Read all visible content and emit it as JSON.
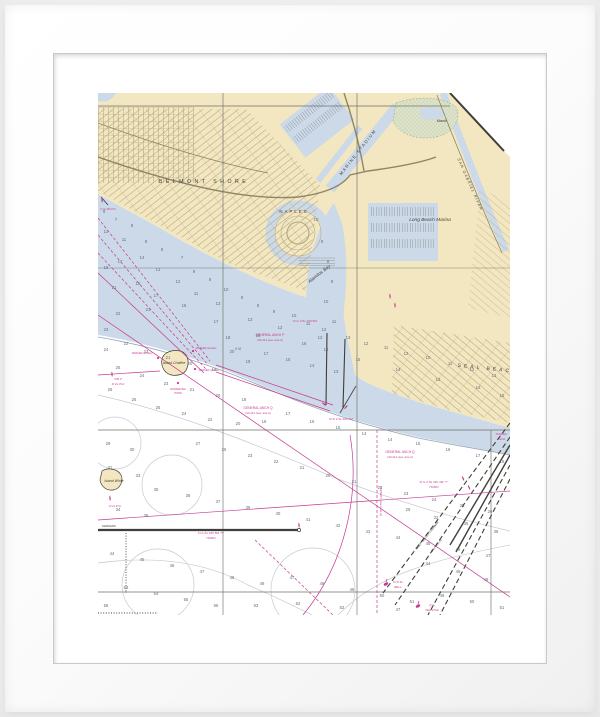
{
  "artwork": {
    "kind": "framed nautical chart art print",
    "subject": "Long Beach / Alamitos Bay / Seal Beach harbor chart"
  },
  "frame": {
    "frame_color": "#ffffff",
    "mat_color": "#ffffff"
  },
  "chart": {
    "colors": {
      "land": "#f2e7c1",
      "water": "#ccd9e8",
      "marsh": "#dde3c9",
      "magenta": "#c63a8f",
      "sounding": "#5f6e7c",
      "contour": "#c3cbd2",
      "street": "#b2a67c",
      "road": "#8f8566",
      "ink": "#3f3e38",
      "graticule": "#6f6f68"
    },
    "labels": [
      {
        "t": "BELMONT SHORE",
        "x": 106,
        "y": 90,
        "r": 0,
        "s": 5.2,
        "c": "ink",
        "sp": 3.5
      },
      {
        "t": "NAPLES",
        "x": 196,
        "y": 120,
        "r": 0,
        "s": 4.4,
        "c": "ink",
        "sp": 2
      },
      {
        "t": "MARINE STADIUM",
        "x": 261,
        "y": 60,
        "r": -52,
        "s": 4.2,
        "c": "ink",
        "sp": 1.5
      },
      {
        "t": "Alamitos Bay",
        "x": 222,
        "y": 182,
        "r": -38,
        "s": 4.6,
        "c": "ink",
        "i": 1
      },
      {
        "t": "Long Beach Marina",
        "x": 332,
        "y": 128,
        "r": 0,
        "s": 4.8,
        "c": "ink",
        "i": 1
      },
      {
        "t": "Marsh",
        "x": 344,
        "y": 29,
        "r": 0,
        "s": 3.8,
        "c": "ink",
        "i": 1
      },
      {
        "t": "SAN GABRIEL RIVER",
        "x": 371,
        "y": 92,
        "r": 66,
        "s": 3.7,
        "c": "ink",
        "sp": 1.2,
        "i": 1
      },
      {
        "t": "SEAL BEACH",
        "x": 390,
        "y": 277,
        "r": 6,
        "s": 5,
        "c": "ink",
        "sp": 3
      },
      {
        "t": "Island Chaffee",
        "x": 76,
        "y": 271,
        "r": 0,
        "s": 3.5,
        "c": "ink",
        "i": 1
      },
      {
        "t": "Island White",
        "x": 16,
        "y": 389,
        "r": 0,
        "s": 3.5,
        "c": "ink",
        "i": 1
      },
      {
        "t": "GENERAL ANCH P",
        "x": 172,
        "y": 243,
        "r": 0,
        "s": 3.3,
        "c": "magenta"
      },
      {
        "t": "110.214 (see note A)",
        "x": 172,
        "y": 248,
        "r": 0,
        "s": 2.8,
        "c": "magenta"
      },
      {
        "t": "GENERAL ANCH Q",
        "x": 160,
        "y": 316,
        "r": 0,
        "s": 3.3,
        "c": "magenta"
      },
      {
        "t": "110.214 (see note A)",
        "x": 160,
        "y": 321,
        "r": 0,
        "s": 2.8,
        "c": "magenta"
      },
      {
        "t": "GENERAL ANCH Q",
        "x": 302,
        "y": 360,
        "r": 0,
        "s": 3.3,
        "c": "magenta"
      },
      {
        "t": "110.214 (see note A)",
        "x": 302,
        "y": 365,
        "r": 0,
        "s": 2.8,
        "c": "magenta"
      },
      {
        "t": "Fl G 2.5s 16ft 5M",
        "x": 207,
        "y": 229,
        "r": 0,
        "s": 3.1,
        "c": "magenta"
      },
      {
        "t": "Fl R 2.5s 20ft 4M",
        "x": 243,
        "y": 327,
        "r": 0,
        "s": 3.1,
        "c": "magenta"
      },
      {
        "t": "Fl G 6s 42ft 5M \"T\"",
        "x": 113,
        "y": 441,
        "r": 0,
        "s": 3.1,
        "c": "magenta"
      },
      {
        "t": "HORN",
        "x": 113,
        "y": 446,
        "r": 0,
        "s": 3.1,
        "c": "magenta"
      },
      {
        "t": "Fl G 2.5s 31ft 4M \"Y\"",
        "x": 336,
        "y": 390,
        "r": 0,
        "s": 3.1,
        "c": "magenta"
      },
      {
        "t": "HORN",
        "x": 336,
        "y": 395,
        "r": 0,
        "s": 3.1,
        "c": "magenta"
      },
      {
        "t": "Fl R 4s",
        "x": 300,
        "y": 490,
        "r": 0,
        "s": 3,
        "c": "magenta"
      },
      {
        "t": "BELL",
        "x": 300,
        "y": 495,
        "r": 0,
        "s": 3,
        "c": "magenta"
      },
      {
        "t": "Q G",
        "x": 334,
        "y": 513,
        "r": 0,
        "s": 3,
        "c": "magenta"
      },
      {
        "t": "WHISTLE",
        "x": 334,
        "y": 518,
        "r": 0,
        "s": 3,
        "c": "magenta"
      },
      {
        "t": "\"OB 2\"",
        "x": 20,
        "y": 287,
        "r": 0,
        "s": 3,
        "c": "magenta",
        "i": 1
      },
      {
        "t": "Fl 2s Priv",
        "x": 20,
        "y": 292,
        "r": 0,
        "s": 3,
        "c": "magenta",
        "i": 1
      },
      {
        "t": "MARKER (private)",
        "x": 44,
        "y": 261,
        "r": 0,
        "s": 2.5,
        "c": "magenta"
      },
      {
        "t": "MARKER (private)",
        "x": 108,
        "y": 256,
        "r": 0,
        "s": 2.5,
        "c": "magenta"
      },
      {
        "t": "MARKER (private)",
        "x": 111,
        "y": 278,
        "r": 0,
        "s": 2.5,
        "c": "magenta"
      },
      {
        "t": "MARKER Bell",
        "x": 80,
        "y": 297,
        "r": 0,
        "s": 2.5,
        "c": "magenta"
      },
      {
        "t": "HORN",
        "x": 80,
        "y": 301,
        "r": 0,
        "s": 2.5,
        "c": "magenta"
      },
      {
        "t": "MARKERS",
        "x": 11,
        "y": 434,
        "r": 0,
        "s": 2.8,
        "c": "ink"
      },
      {
        "t": "Fl 2s Priv",
        "x": 17,
        "y": 414,
        "r": 0,
        "s": 2.9,
        "c": "magenta",
        "i": 1
      },
      {
        "t": "Fl 4s 30ft Priv",
        "x": 10,
        "y": 117,
        "r": 0,
        "s": 2.5,
        "c": "magenta"
      },
      {
        "t": "FAIRWAY (see note A)",
        "x": 282,
        "y": 408,
        "r": 90,
        "s": 3,
        "c": "magenta"
      },
      {
        "t": "DEEP WATER FAIRWAY",
        "x": 330,
        "y": 443,
        "r": -51,
        "s": 3.2,
        "c": "ink"
      },
      {
        "t": "(see note A)",
        "x": 339,
        "y": 453,
        "r": -51,
        "s": 2.9,
        "c": "ink"
      },
      {
        "t": "TANKER",
        "x": 403,
        "y": 342,
        "r": 0,
        "s": 2.9,
        "c": "magenta"
      },
      {
        "t": "ANCH",
        "x": 403,
        "y": 347,
        "r": 0,
        "s": 2.9,
        "c": "magenta"
      },
      {
        "t": "6 M",
        "x": 140,
        "y": 257,
        "r": 0,
        "s": 3.4,
        "c": "sounding",
        "i": 1
      }
    ],
    "soundings": [
      [
        6,
        120,
        "9"
      ],
      [
        18,
        128,
        "7"
      ],
      [
        34,
        134,
        "8"
      ],
      [
        8,
        140,
        "12"
      ],
      [
        26,
        148,
        "11"
      ],
      [
        48,
        150,
        "9"
      ],
      [
        64,
        158,
        "8"
      ],
      [
        84,
        166,
        "7"
      ],
      [
        44,
        166,
        "14"
      ],
      [
        22,
        170,
        "17"
      ],
      [
        8,
        176,
        "18"
      ],
      [
        60,
        178,
        "13"
      ],
      [
        96,
        180,
        "9"
      ],
      [
        112,
        188,
        "8"
      ],
      [
        80,
        190,
        "12"
      ],
      [
        40,
        192,
        "18"
      ],
      [
        16,
        196,
        "21"
      ],
      [
        58,
        204,
        "17"
      ],
      [
        98,
        202,
        "11"
      ],
      [
        128,
        198,
        "10"
      ],
      [
        144,
        206,
        "9"
      ],
      [
        120,
        212,
        "13"
      ],
      [
        86,
        214,
        "16"
      ],
      [
        50,
        218,
        "21"
      ],
      [
        20,
        222,
        "22"
      ],
      [
        160,
        214,
        "8"
      ],
      [
        176,
        220,
        "9"
      ],
      [
        196,
        224,
        "10"
      ],
      [
        152,
        228,
        "13"
      ],
      [
        118,
        230,
        "17"
      ],
      [
        182,
        236,
        "12"
      ],
      [
        210,
        232,
        "11"
      ],
      [
        226,
        238,
        "12"
      ],
      [
        160,
        244,
        "15"
      ],
      [
        130,
        246,
        "18"
      ],
      [
        250,
        246,
        "13"
      ],
      [
        268,
        252,
        "12"
      ],
      [
        288,
        256,
        "11"
      ],
      [
        308,
        262,
        "12"
      ],
      [
        330,
        266,
        "10"
      ],
      [
        352,
        272,
        "11"
      ],
      [
        374,
        278,
        "12"
      ],
      [
        396,
        284,
        "13"
      ],
      [
        260,
        268,
        "15"
      ],
      [
        300,
        278,
        "14"
      ],
      [
        340,
        288,
        "13"
      ],
      [
        380,
        296,
        "14"
      ],
      [
        404,
        304,
        "15"
      ],
      [
        228,
        258,
        "14"
      ],
      [
        206,
        252,
        "16"
      ],
      [
        8,
        238,
        "23"
      ],
      [
        8,
        258,
        "24"
      ],
      [
        28,
        252,
        "22"
      ],
      [
        48,
        260,
        "23"
      ],
      [
        70,
        266,
        "21"
      ],
      [
        92,
        272,
        "20"
      ],
      [
        116,
        278,
        "19"
      ],
      [
        20,
        276,
        "25"
      ],
      [
        44,
        284,
        "24"
      ],
      [
        68,
        292,
        "23"
      ],
      [
        94,
        298,
        "21"
      ],
      [
        120,
        304,
        "20"
      ],
      [
        146,
        308,
        "18"
      ],
      [
        12,
        298,
        "26"
      ],
      [
        36,
        308,
        "26"
      ],
      [
        60,
        316,
        "25"
      ],
      [
        86,
        322,
        "24"
      ],
      [
        112,
        328,
        "22"
      ],
      [
        140,
        332,
        "20"
      ],
      [
        166,
        330,
        "18"
      ],
      [
        190,
        322,
        "17"
      ],
      [
        214,
        330,
        "16"
      ],
      [
        240,
        336,
        "15"
      ],
      [
        266,
        342,
        "14"
      ],
      [
        292,
        348,
        "14"
      ],
      [
        320,
        352,
        "15"
      ],
      [
        350,
        358,
        "16"
      ],
      [
        380,
        364,
        "17"
      ],
      [
        404,
        370,
        "18"
      ],
      [
        168,
        262,
        "17"
      ],
      [
        190,
        268,
        "15"
      ],
      [
        214,
        274,
        "14"
      ],
      [
        238,
        280,
        "13"
      ],
      [
        150,
        270,
        "19"
      ],
      [
        134,
        260,
        "20"
      ],
      [
        10,
        352,
        "29"
      ],
      [
        34,
        358,
        "30"
      ],
      [
        12,
        376,
        "31"
      ],
      [
        40,
        384,
        "33"
      ],
      [
        100,
        352,
        "27"
      ],
      [
        126,
        358,
        "25"
      ],
      [
        152,
        364,
        "23"
      ],
      [
        178,
        370,
        "22"
      ],
      [
        204,
        376,
        "21"
      ],
      [
        230,
        384,
        "20"
      ],
      [
        256,
        390,
        "21"
      ],
      [
        282,
        396,
        "22"
      ],
      [
        308,
        402,
        "23"
      ],
      [
        336,
        408,
        "24"
      ],
      [
        364,
        414,
        "25"
      ],
      [
        392,
        420,
        "26"
      ],
      [
        58,
        398,
        "35"
      ],
      [
        90,
        404,
        "36"
      ],
      [
        120,
        410,
        "37"
      ],
      [
        150,
        416,
        "38"
      ],
      [
        180,
        422,
        "40"
      ],
      [
        210,
        428,
        "41"
      ],
      [
        240,
        434,
        "42"
      ],
      [
        270,
        440,
        "43"
      ],
      [
        300,
        446,
        "44"
      ],
      [
        330,
        452,
        "45"
      ],
      [
        360,
        458,
        "46"
      ],
      [
        390,
        464,
        "47"
      ],
      [
        20,
        418,
        "34"
      ],
      [
        48,
        424,
        "36"
      ],
      [
        14,
        462,
        "44"
      ],
      [
        44,
        468,
        "45"
      ],
      [
        74,
        474,
        "46"
      ],
      [
        104,
        480,
        "47"
      ],
      [
        134,
        486,
        "48"
      ],
      [
        164,
        492,
        "49"
      ],
      [
        194,
        486,
        "47"
      ],
      [
        224,
        492,
        "48"
      ],
      [
        254,
        498,
        "49"
      ],
      [
        284,
        504,
        "50"
      ],
      [
        314,
        510,
        "51"
      ],
      [
        344,
        504,
        "49"
      ],
      [
        374,
        510,
        "50"
      ],
      [
        404,
        516,
        "51"
      ],
      [
        28,
        496,
        "53"
      ],
      [
        58,
        502,
        "54"
      ],
      [
        88,
        508,
        "55"
      ],
      [
        118,
        514,
        "56"
      ],
      [
        158,
        514,
        "53"
      ],
      [
        200,
        512,
        "52"
      ],
      [
        244,
        516,
        "52"
      ],
      [
        8,
        514,
        "56"
      ],
      [
        300,
        518,
        "47"
      ],
      [
        388,
        488,
        "48"
      ],
      [
        360,
        480,
        "46"
      ],
      [
        330,
        472,
        "44"
      ],
      [
        398,
        440,
        "38"
      ],
      [
        368,
        432,
        "35"
      ],
      [
        338,
        426,
        "32"
      ],
      [
        310,
        418,
        "29"
      ],
      [
        218,
        128,
        "10"
      ],
      [
        224,
        150,
        "9"
      ],
      [
        230,
        170,
        "8"
      ],
      [
        234,
        190,
        "9"
      ],
      [
        228,
        210,
        "10"
      ],
      [
        236,
        230,
        "11"
      ],
      [
        222,
        246,
        "12"
      ]
    ]
  }
}
